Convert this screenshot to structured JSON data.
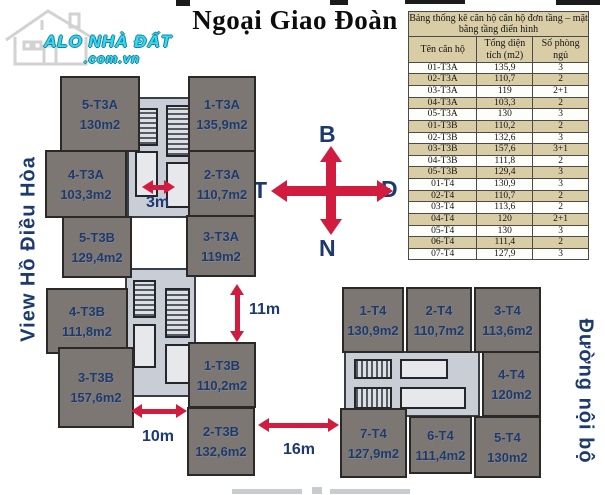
{
  "title": {
    "main": "Ngoại Giao Đoàn"
  },
  "logo": {
    "name": "ALO NHÀ ĐẤT",
    "domain": ".com.vn"
  },
  "side_labels": {
    "left": "View  Hồ Điều Hòa",
    "right": "Đường nội bộ"
  },
  "compass": {
    "north": "B",
    "east": "Đ",
    "south": "N",
    "west": "T"
  },
  "dimensions": [
    {
      "label": "3m"
    },
    {
      "label": "11m"
    },
    {
      "label": "10m"
    },
    {
      "label": "16m"
    }
  ],
  "table": {
    "title": "Bảng thống kê căn hộ căn hộ đơn tầng – mặt bằng tầng điển hình",
    "columns": [
      "Tên căn hộ",
      "Tổng diện tích (m2)",
      "Số phòng ngủ"
    ],
    "rows": [
      [
        "01-T3A",
        "135,9",
        "3"
      ],
      [
        "02-T3A",
        "110,7",
        "2"
      ],
      [
        "03-T3A",
        "119",
        "2+1"
      ],
      [
        "04-T3A",
        "103,3",
        "2"
      ],
      [
        "05-T3A",
        "130",
        "3"
      ],
      [
        "01-T3B",
        "110,2",
        "2"
      ],
      [
        "02-T3B",
        "132,6",
        "3"
      ],
      [
        "03-T3B",
        "157,6",
        "3+1"
      ],
      [
        "04-T3B",
        "111,8",
        "2"
      ],
      [
        "05-T3B",
        "129,4",
        "3"
      ],
      [
        "01-T4",
        "130,9",
        "3"
      ],
      [
        "02-T4",
        "110,7",
        "2"
      ],
      [
        "03-T4",
        "113,6",
        "2"
      ],
      [
        "04-T4",
        "120",
        "2+1"
      ],
      [
        "05-T4",
        "130",
        "3"
      ],
      [
        "06-T4",
        "111,4",
        "2"
      ],
      [
        "07-T4",
        "127,9",
        "3"
      ]
    ]
  },
  "units": [
    {
      "id": "5-T3A",
      "area": "130m2"
    },
    {
      "id": "1-T3A",
      "area": "135,9m2"
    },
    {
      "id": "4-T3A",
      "area": "103,3m2"
    },
    {
      "id": "2-T3A",
      "area": "110,7m2"
    },
    {
      "id": "3-T3A",
      "area": "119m2"
    },
    {
      "id": "5-T3B",
      "area": "129,4m2"
    },
    {
      "id": "4-T3B",
      "area": "111,8m2"
    },
    {
      "id": "3-T3B",
      "area": "157,6m2"
    },
    {
      "id": "1-T3B",
      "area": "110,2m2"
    },
    {
      "id": "2-T3B",
      "area": "132,6m2"
    },
    {
      "id": "1-T4",
      "area": "130,9m2"
    },
    {
      "id": "2-T4",
      "area": "110,7m2"
    },
    {
      "id": "3-T4",
      "area": "113,6m2"
    },
    {
      "id": "4-T4",
      "area": "120m2"
    },
    {
      "id": "7-T4",
      "area": "127,9m2"
    },
    {
      "id": "6-T4",
      "area": "111,4m2"
    },
    {
      "id": "5-T4",
      "area": "130m2"
    }
  ],
  "colors": {
    "accent_red": "#d21c3f",
    "navy_text": "#1c3a6e",
    "unit_fill": "#7d7774",
    "core_fill": "#c9ced6",
    "table_tan": "#d9cda6",
    "logo_cyan": "#3bd6ec",
    "title_black": "#0d0d0d"
  }
}
